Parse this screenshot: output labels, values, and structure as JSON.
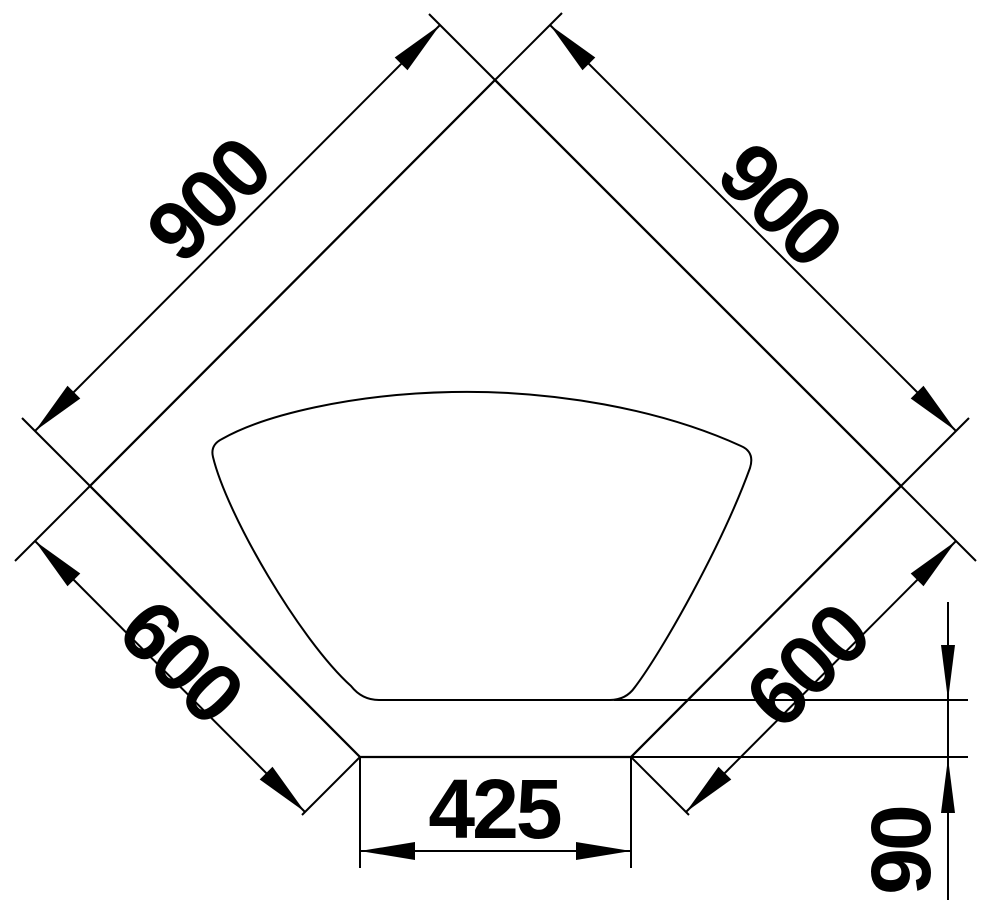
{
  "drawing": {
    "type": "technical-dimension-drawing",
    "subject": "corner-sink-top-view",
    "line_color": "#000000",
    "background_color": "#ffffff",
    "dimensions": {
      "back_left_edge": "900",
      "back_right_edge": "900",
      "front_left_edge": "600",
      "front_right_edge": "600",
      "front_center_edge": "425",
      "bowl_to_front_offset": "90"
    }
  }
}
